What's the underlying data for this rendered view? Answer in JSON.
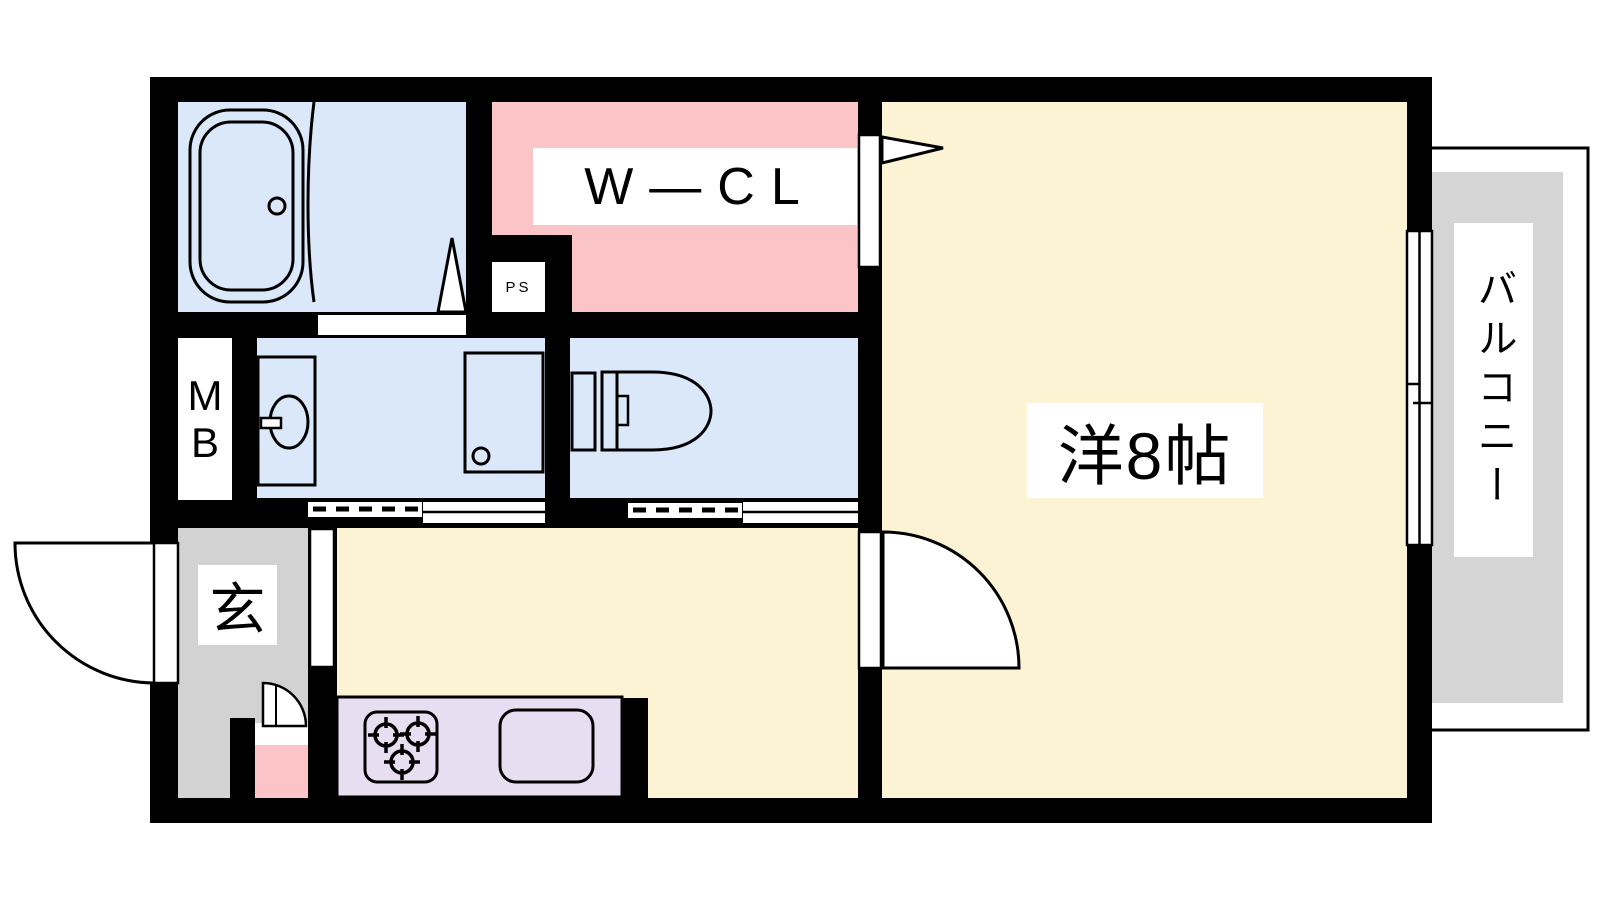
{
  "plan": {
    "type": "apartment-floor-plan",
    "labels": {
      "walk_in_closet": "W―CL",
      "pipe_space": "PS",
      "meter_box_line1": "M",
      "meter_box_line2": "B",
      "entrance": "玄",
      "western_room": "洋8帖",
      "balcony": "バルコニー"
    },
    "colors": {
      "wall": "#000000",
      "wet_area_blue": "#dae8fa",
      "closet_pink": "#fbc5c8",
      "room_cream": "#fcf2d4",
      "kitchen_counter_purple": "#e8def2",
      "entrance_gray": "#d2d2d2",
      "balcony_gray": "#d5d5d5",
      "background": "#ffffff"
    }
  }
}
